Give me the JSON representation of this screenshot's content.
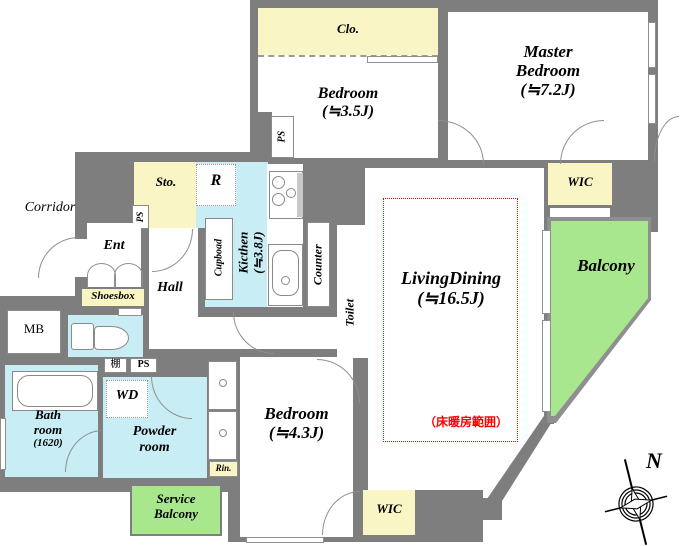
{
  "colors": {
    "wall": "#7E7E7E",
    "closet_yellow": "#FAF5C5",
    "wet_area_blue": "#C9EDF5",
    "balcony_green": "#A9E78F",
    "floor_heating_red": "#FF0000"
  },
  "labels": {
    "corridor": "Corridor",
    "clo": "Clo.",
    "bedroom1_name": "Bedroom",
    "bedroom1_size": "(≒3.5J)",
    "master_line1": "Master",
    "master_line2": "Bedroom",
    "master_size": "(≒7.2J)",
    "wic": "WIC",
    "balcony": "Balcony",
    "sto": "Sto.",
    "refrigerator": "R",
    "ps": "PS",
    "ent": "Ent",
    "hall": "Hall",
    "shoesbox": "Shoesbox",
    "mb": "MB",
    "cupboard": "Cupboad",
    "kitchen_name": "Kicthen",
    "kitchen_size": "(≒3.8J)",
    "counter": "Counter",
    "toilet": "Toilet",
    "living_name": "LivingDining",
    "living_size": "(≒16.5J)",
    "floor_heating": "（床暖房範囲）",
    "shelf": "棚",
    "wd": "WD",
    "bath_line1": "Bath",
    "bath_line2": "room",
    "bath_size": "(1620)",
    "powder_line1": "Powder",
    "powder_line2": "room",
    "rin": "Rin.",
    "service_line1": "Service",
    "service_line2": "Balcony",
    "bedroom2_name": "Bedroom",
    "bedroom2_size": "(≒4.3J)",
    "compass_north": "N"
  }
}
